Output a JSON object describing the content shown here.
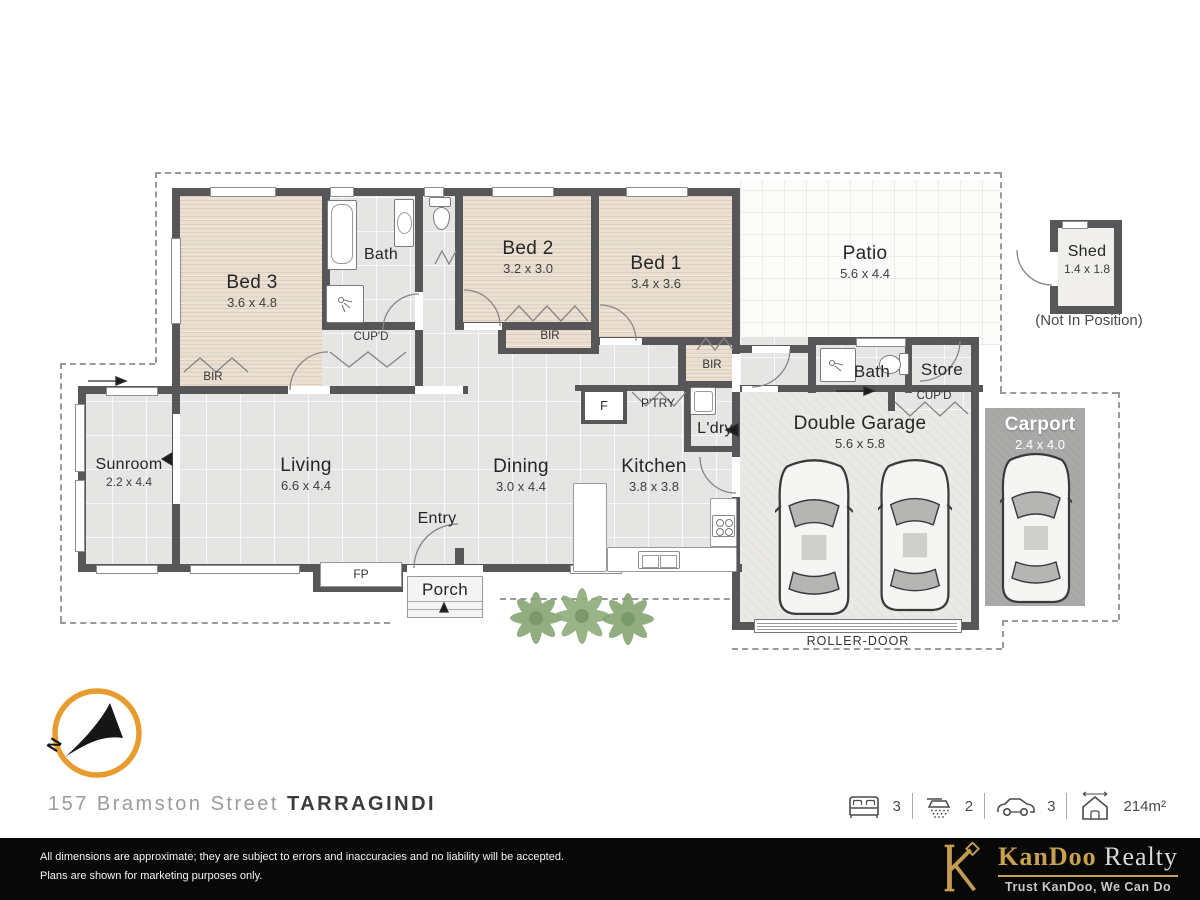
{
  "meta": {
    "address_street": "157 Bramston Street",
    "address_suburb": "TARRAGINDI"
  },
  "stats": {
    "beds": "3",
    "baths": "2",
    "cars": "3",
    "area": "214m²"
  },
  "compass": {
    "north": "N"
  },
  "rooms": {
    "bed3": {
      "name": "Bed 3",
      "dims": "3.6 x 4.8"
    },
    "bath1": {
      "name": "Bath"
    },
    "bed2": {
      "name": "Bed 2",
      "dims": "3.2 x 3.0"
    },
    "bed1": {
      "name": "Bed 1",
      "dims": "3.4 x 3.6"
    },
    "patio": {
      "name": "Patio",
      "dims": "5.6 x 4.4"
    },
    "shed": {
      "name": "Shed",
      "dims": "1.4 x 1.8",
      "note": "(Not In Position)"
    },
    "sunroom": {
      "name": "Sunroom",
      "dims": "2.2 x 4.4"
    },
    "living": {
      "name": "Living",
      "dims": "6.6 x 4.4"
    },
    "dining": {
      "name": "Dining",
      "dims": "3.0 x 4.4"
    },
    "kitchen": {
      "name": "Kitchen",
      "dims": "3.8 x 3.8"
    },
    "entry": {
      "name": "Entry"
    },
    "porch": {
      "name": "Porch"
    },
    "ldry": {
      "name": "L'dry"
    },
    "bath2": {
      "name": "Bath"
    },
    "store": {
      "name": "Store"
    },
    "garage": {
      "name": "Double Garage",
      "dims": "5.6 x 5.8"
    },
    "carport": {
      "name": "Carport",
      "dims": "2.4 x 4.0"
    }
  },
  "labels": {
    "bir": "BIR",
    "cupd": "CUP'D",
    "fp": "FP",
    "fridge": "F",
    "pantry": "P'TRY",
    "roller_door": "ROLLER-DOOR"
  },
  "footer": {
    "disclaimer_line1": "All dimensions are approximate; they are subject to errors and inaccuracies and no liability will be accepted.",
    "disclaimer_line2": "Plans are shown for marketing purposes only.",
    "brand_name_gold": "KanDoo",
    "brand_name_silver": "Realty",
    "tagline": "Trust KanDoo, We Can Do"
  },
  "colors": {
    "accent_orange": "#E89B2E",
    "brand_gold": "#C9A04E",
    "wall": "#57575A"
  }
}
